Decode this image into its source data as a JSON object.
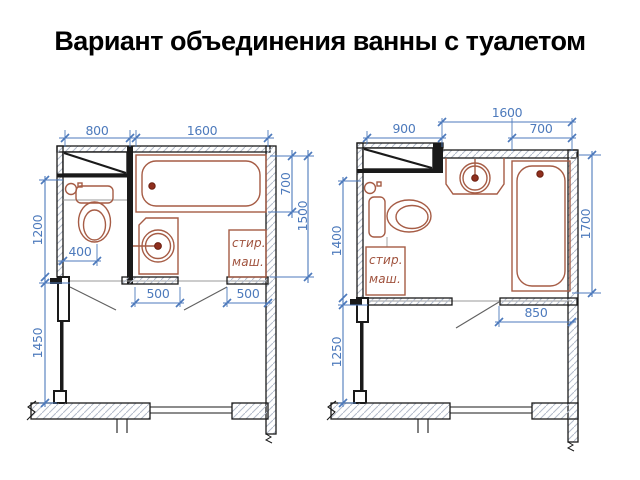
{
  "title": "Вариант объединения ванны с туалетом",
  "colors": {
    "dimension_blue": "#4d7abc",
    "fixture_brown": "#a65c45",
    "wall_black": "#1a1a1a",
    "drain_red": "#8f2f1e",
    "hatch_gray": "#b3bccb"
  },
  "plan_left": {
    "dims": {
      "d800": "800",
      "d1600": "1600",
      "d700": "700",
      "d1500": "1500",
      "d1200": "1200",
      "d1450": "1450",
      "d400": "400",
      "d500a": "500",
      "d500b": "500"
    },
    "washer": {
      "line1": "стир.",
      "line2": "маш."
    }
  },
  "plan_right": {
    "dims": {
      "d900": "900",
      "d1600": "1600",
      "d700": "700",
      "d1700": "1700",
      "d1400": "1400",
      "d1250": "1250",
      "d850": "850"
    },
    "washer": {
      "line1": "стир.",
      "line2": "маш."
    }
  }
}
